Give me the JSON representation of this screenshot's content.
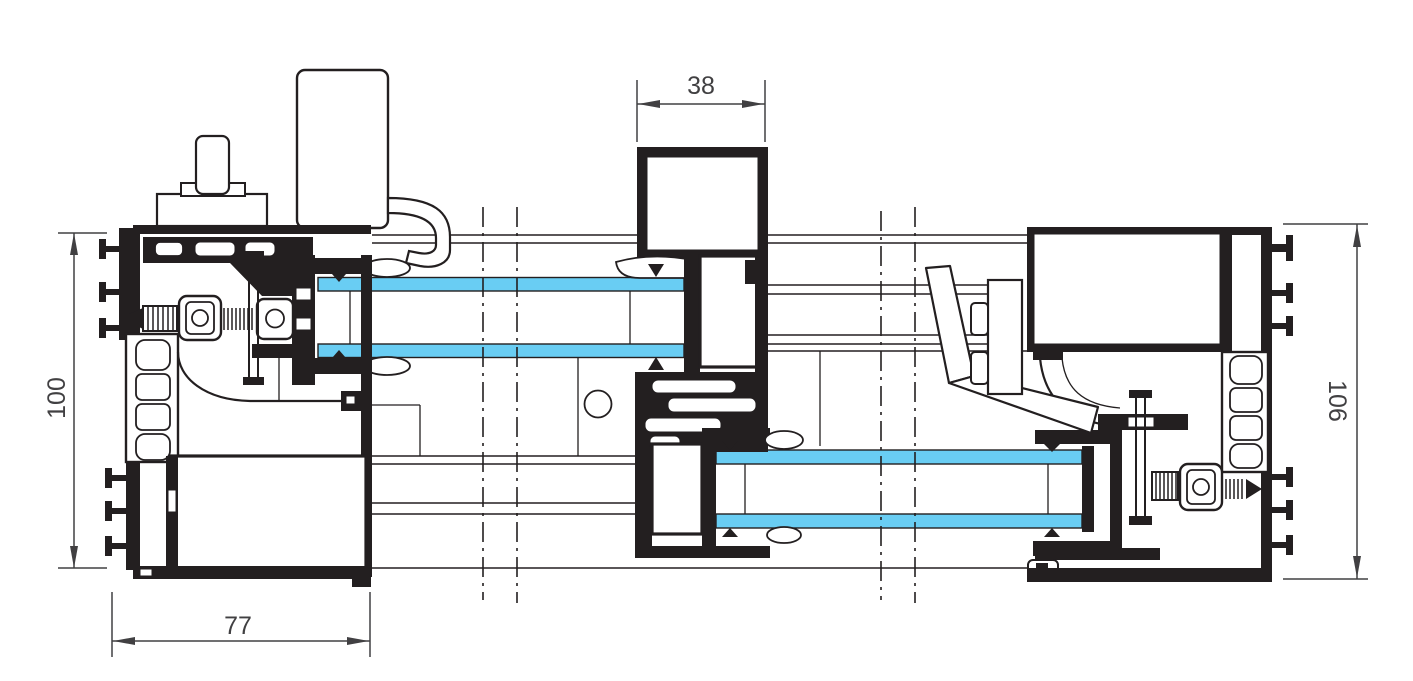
{
  "colors": {
    "line": "#231f20",
    "glass": "#69cdf3",
    "dim_text": "#414042",
    "background": "#ffffff"
  },
  "dimensions": {
    "left": {
      "label": "100",
      "orientation": "vertical",
      "position": "left"
    },
    "bottom_left": {
      "label": "77",
      "orientation": "horizontal",
      "position": "bottom-left"
    },
    "top_center": {
      "label": "38",
      "orientation": "horizontal",
      "position": "top-center"
    },
    "right": {
      "label": "106",
      "orientation": "vertical",
      "position": "right"
    }
  },
  "glazing": {
    "units": 2,
    "panes_per_unit": 2
  },
  "break_lines": {
    "count": 4,
    "style": "dash-dot"
  },
  "components": {
    "left_section": "left jamb profile",
    "middle_section": "central interlock profile",
    "right_section": "right jamb profile"
  }
}
